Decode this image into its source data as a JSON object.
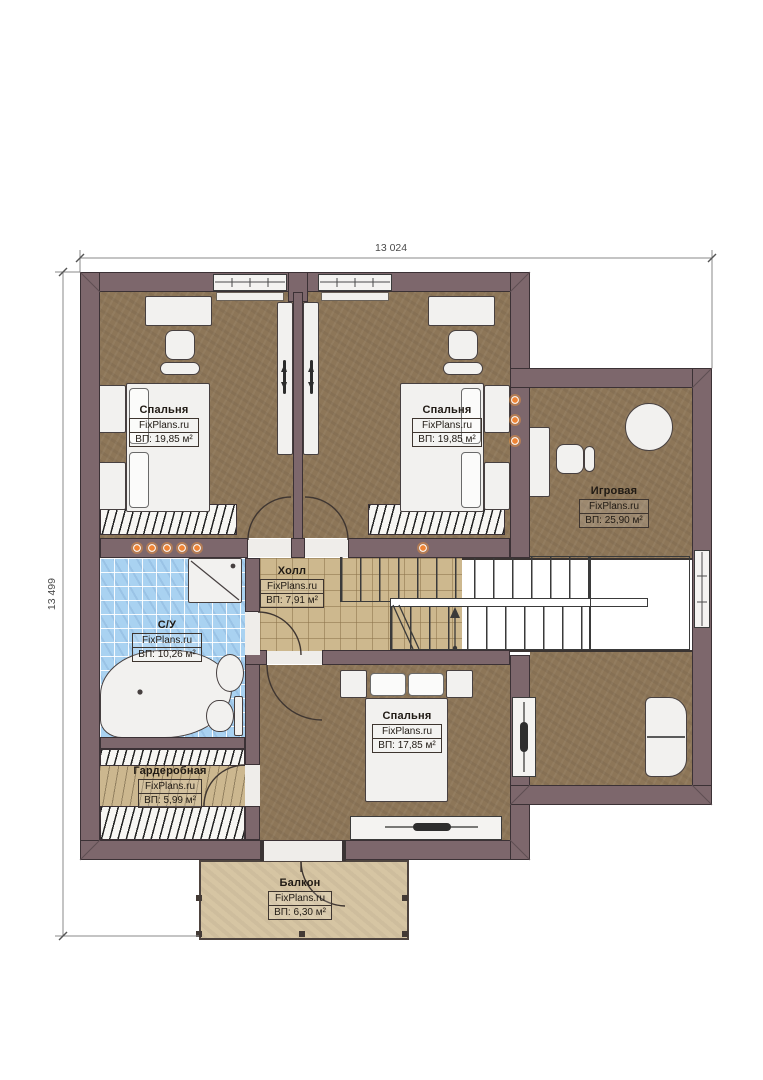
{
  "plan": {
    "brand": "FixPlans.ru",
    "dimensions": {
      "width_label": "13 024",
      "height_label": "13 499"
    },
    "rooms": {
      "bedroom_top_left": {
        "name": "Спальня",
        "brand": "FixPlans.ru",
        "area": "ВП: 19,85 м²"
      },
      "bedroom_top_right": {
        "name": "Спальня",
        "brand": "FixPlans.ru",
        "area": "ВП: 19,85 м²"
      },
      "playroom": {
        "name": "Игровая",
        "brand": "FixPlans.ru",
        "area": "ВП: 25,90 м²"
      },
      "hall": {
        "name": "Холл",
        "brand": "FixPlans.ru",
        "area": "ВП: 7,91 м²"
      },
      "bathroom": {
        "name": "С/У",
        "brand": "FixPlans.ru",
        "area": "ВП: 10,26 м²"
      },
      "bedroom_bottom": {
        "name": "Спальня",
        "brand": "FixPlans.ru",
        "area": "ВП: 17,85 м²"
      },
      "wardrobe": {
        "name": "Гардеробная",
        "brand": "FixPlans.ru",
        "area": "ВП: 5,99 м²"
      },
      "balcony": {
        "name": "Балкон",
        "brand": "FixPlans.ru",
        "area": "ВП: 6,30 м²"
      }
    },
    "colors": {
      "wall": "#7d676c",
      "wood_floor": "#8d7658",
      "hall_tile": "#cdb88e",
      "bath_tile": "#a9d2f1",
      "balcony_floor": "#d6c5a3",
      "spotlight": "#ef8435"
    }
  }
}
